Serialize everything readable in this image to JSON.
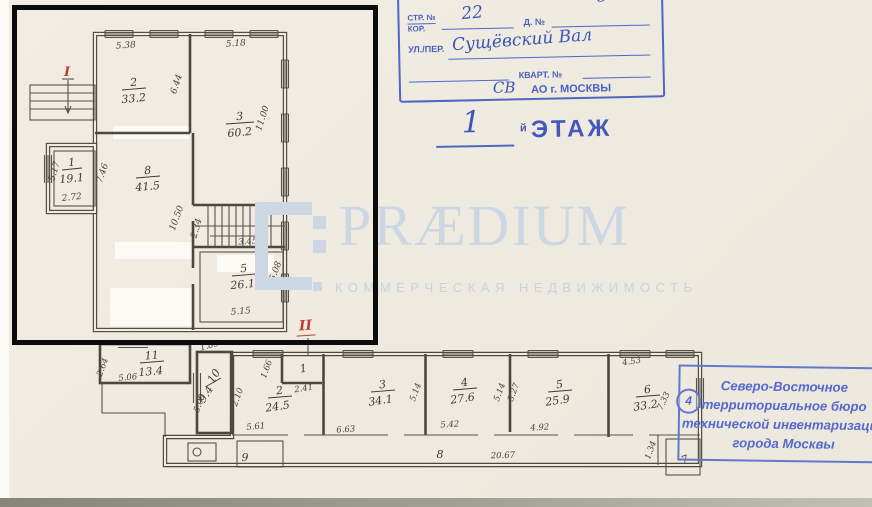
{
  "colors": {
    "stamp_blue": "#4a5fc0",
    "handwriting_blue": "#3b55b8",
    "watermark_blue": "#cdd7e4",
    "section_red": "#c23b2e",
    "plan_ink": "#4b483f"
  },
  "stamp_top": {
    "str_label": "СТР. №",
    "kor_label": "КОР.",
    "str_value": "22",
    "d_label": "Д. №",
    "d_value": "5",
    "ul_label": "УЛ./ПЕР.",
    "ul_value": "Сущёвский Вал",
    "kvart_label": "КВАРТ. №",
    "ao_value": "СВ",
    "ao_label": "АО г. МОСКВЫ"
  },
  "floor_header": {
    "value": "1",
    "suffix": "й",
    "label": "ЭТАЖ"
  },
  "watermark": {
    "brand": "PRÆDIUM",
    "tagline": "КОММЕРЧЕСКАЯ НЕДВИЖИМОСТЬ"
  },
  "stamp_bottom": {
    "badge": "4",
    "lines": [
      "Северо-Восточное",
      "территориальное бюро",
      "технической инвентаризации",
      "города Москвы"
    ]
  },
  "plan_upper": {
    "section_mark": "I",
    "rooms": {
      "r1": {
        "num": "1",
        "area": "19.1"
      },
      "r2": {
        "num": "2",
        "area": "33.2"
      },
      "r3": {
        "num": "3",
        "area": "60.2"
      },
      "r4": {
        "num": "4"
      },
      "r5": {
        "num": "5",
        "area": "26.1"
      },
      "r8": {
        "num": "8",
        "area": "41.5"
      }
    },
    "dims": {
      "top_r2": "5.38",
      "top_r3": "5.18",
      "right_r2": "6.44",
      "right_r3": "11.00",
      "left_r1": "5.17",
      "bottom_r1": "2.72",
      "left_r8": "7.46",
      "left_stair": "10.50",
      "stair_w": "2.34",
      "stair_b": "3.45",
      "bottom_r5": "5.15",
      "right_r5": "5.08"
    }
  },
  "plan_lower": {
    "section_mark": "II",
    "rooms": {
      "r1": {
        "num": "1"
      },
      "r2": {
        "num": "2",
        "area": "24.5"
      },
      "r3": {
        "num": "3",
        "area": "34.1"
      },
      "r4": {
        "num": "4",
        "area": "27.6"
      },
      "r5": {
        "num": "5",
        "area": "25.9"
      },
      "r6": {
        "num": "6",
        "area": "33.2"
      },
      "r7": {
        "num": "7"
      },
      "r8": {
        "num": "8"
      },
      "r9": {
        "num": "9"
      },
      "r10": {
        "num": "10",
        "area": "9.4"
      },
      "r11": {
        "num": "11",
        "area": "13.4"
      }
    },
    "dims": {
      "r11_b": "5.06",
      "r11_l": "2.64",
      "r10_t": "1.85",
      "r10_l": "5.09",
      "r2_l": "2.10",
      "r2_b": "5.61",
      "r1_l": "1.66",
      "r1_b": "2.41",
      "r3_b": "6.63",
      "r3_r": "5.14",
      "r4_b": "5.42",
      "r4_r": "5.14",
      "r5_l": "5.27",
      "r5_b": "4.92",
      "r6_t": "4.53",
      "r6_r": "7.33",
      "corridor": "20.67",
      "corridor_n": "1.34"
    }
  }
}
